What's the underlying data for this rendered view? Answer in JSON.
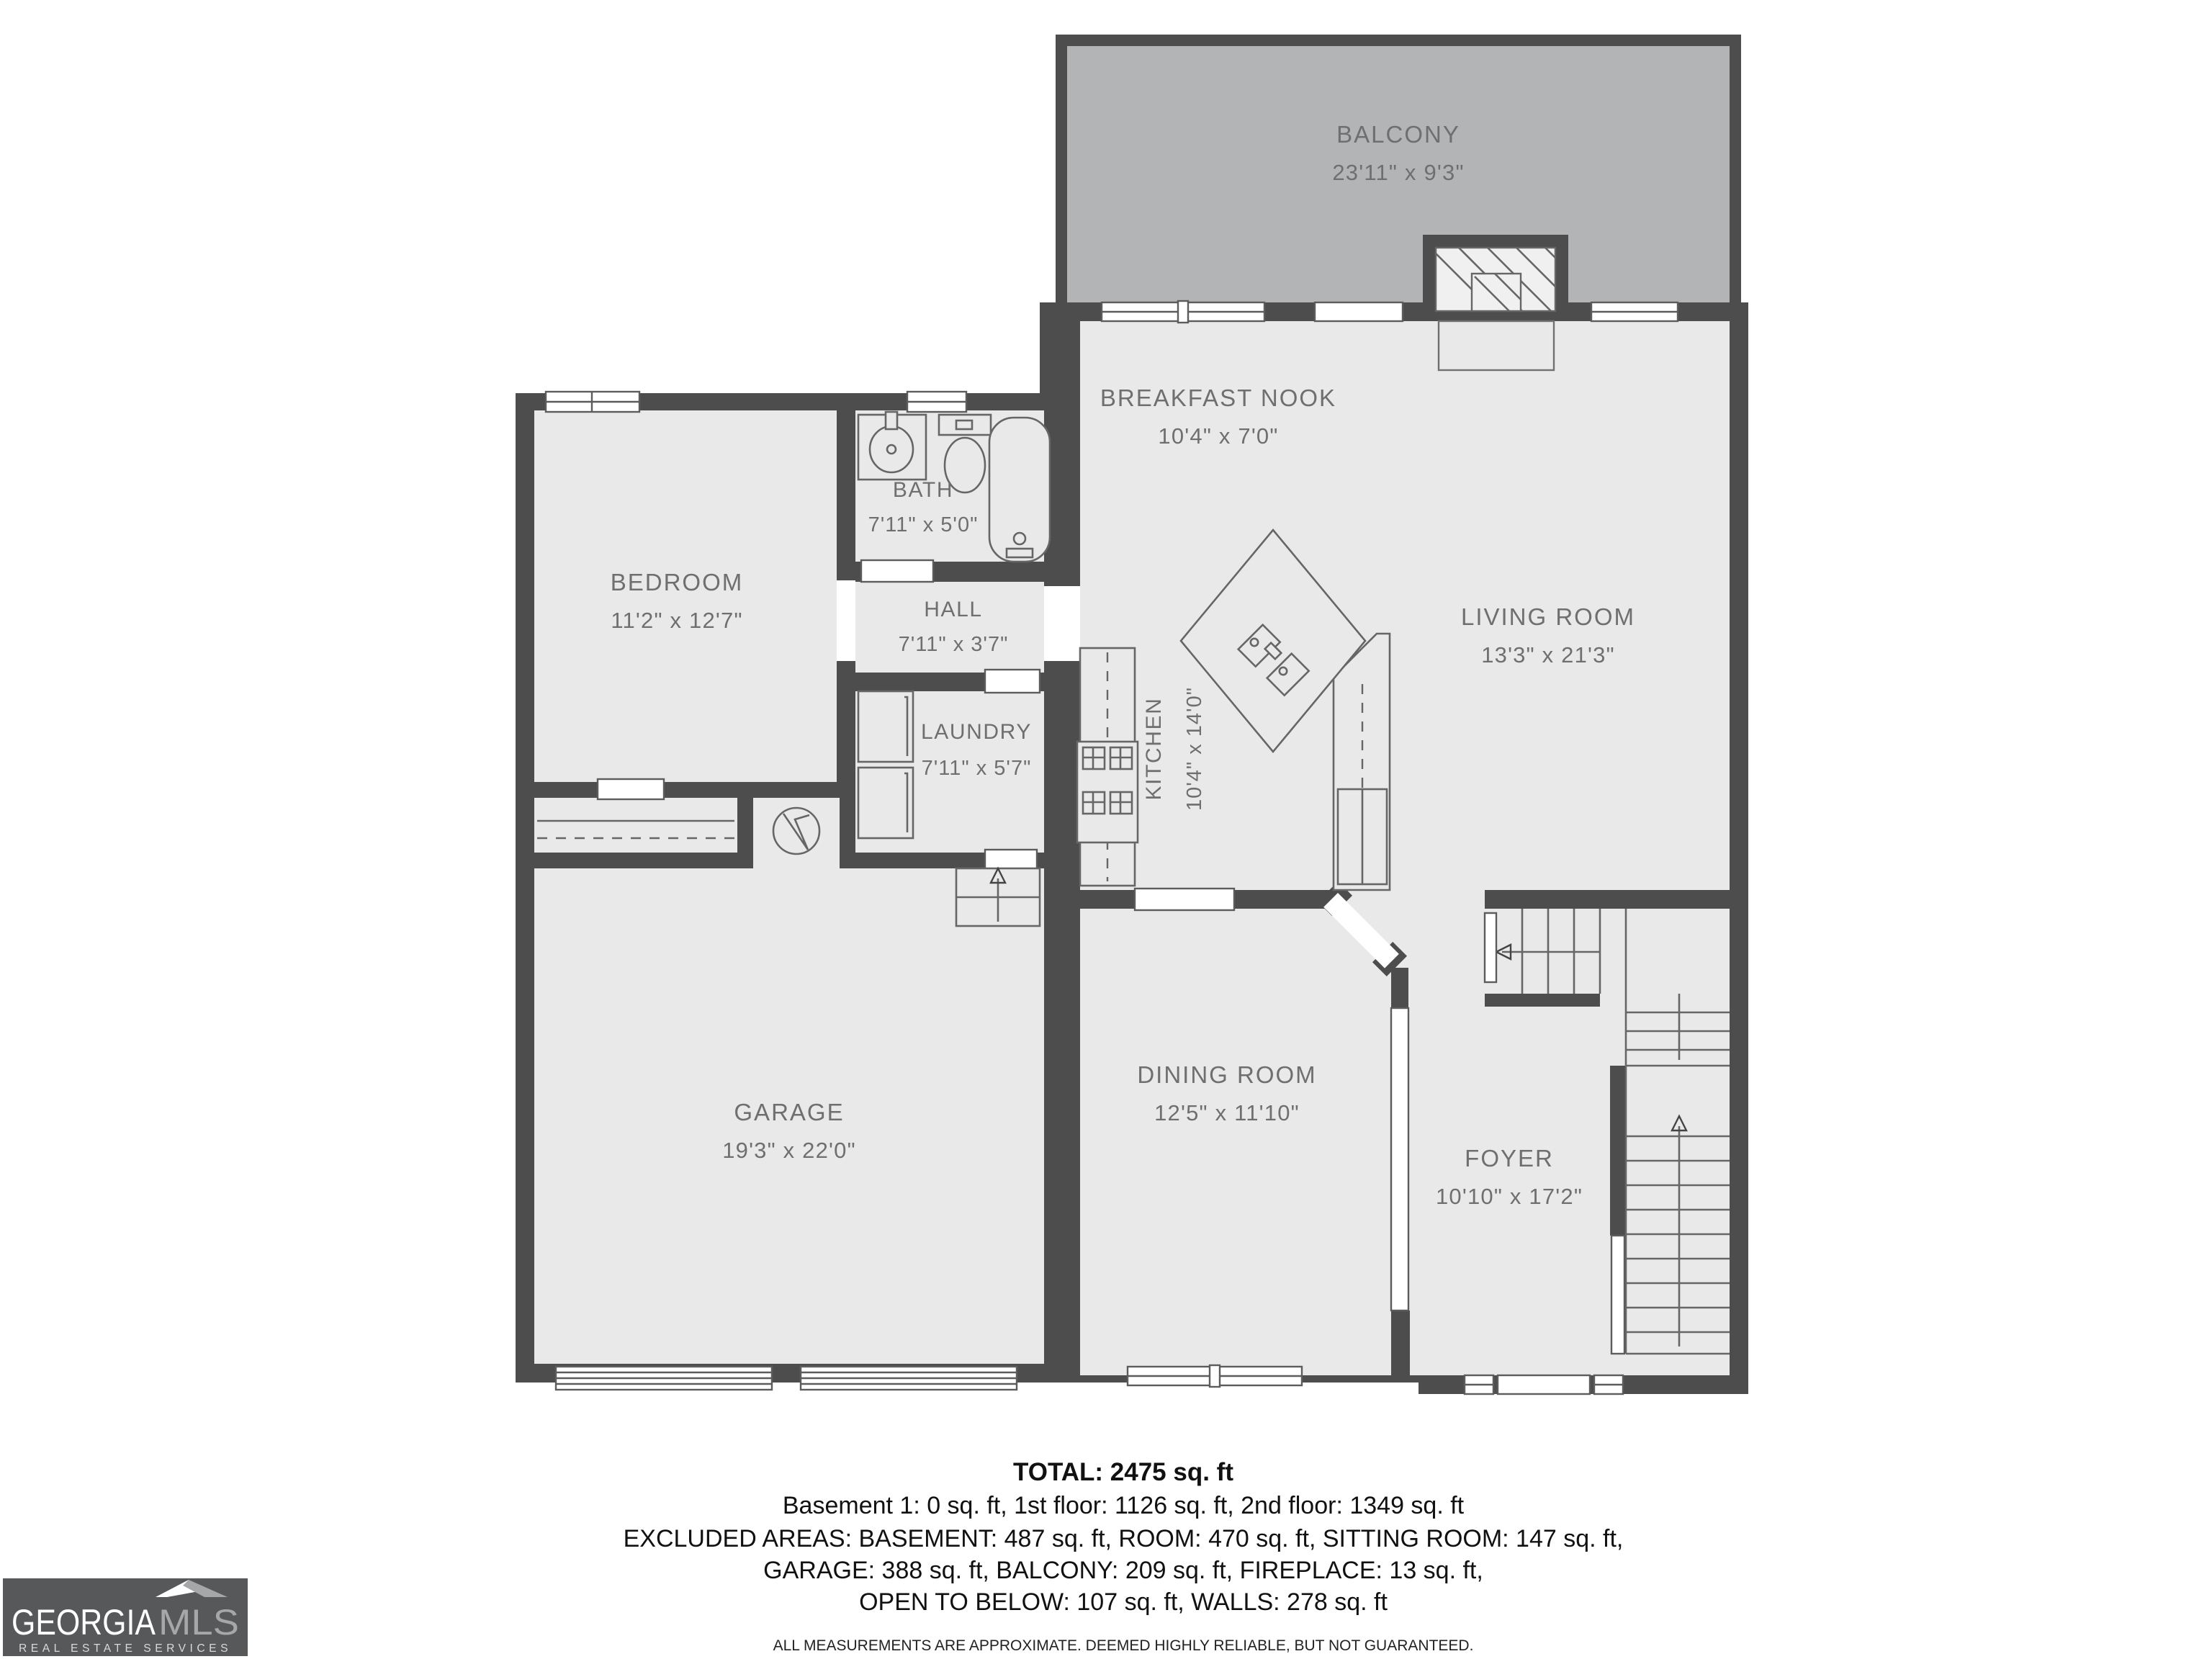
{
  "plan": {
    "rooms": [
      {
        "name": "BALCONY",
        "dims": "23'11\" x 9'3\""
      },
      {
        "name": "BREAKFAST NOOK",
        "dims": "10'4\" x 7'0\""
      },
      {
        "name": "LIVING ROOM",
        "dims": "13'3\" x 21'3\""
      },
      {
        "name": "BEDROOM",
        "dims": "11'2\" x 12'7\""
      },
      {
        "name": "BATH",
        "dims": "7'11\" x 5'0\""
      },
      {
        "name": "HALL",
        "dims": "7'11\" x 3'7\""
      },
      {
        "name": "LAUNDRY",
        "dims": "7'11\" x 5'7\""
      },
      {
        "name": "KITCHEN",
        "dims": "10'4\" x 14'0\""
      },
      {
        "name": "GARAGE",
        "dims": "19'3\" x 22'0\""
      },
      {
        "name": "DINING ROOM",
        "dims": "12'5\" x 11'10\""
      },
      {
        "name": "FOYER",
        "dims": "10'10\" x 17'2\""
      }
    ],
    "footer": {
      "total": "TOTAL: 2475 sq. ft",
      "line1": "Basement 1: 0 sq. ft, 1st floor: 1126 sq. ft, 2nd floor: 1349 sq. ft",
      "line2": "EXCLUDED AREAS: BASEMENT: 487 sq. ft, ROOM: 470 sq. ft, SITTING ROOM: 147 sq. ft,",
      "line3": "GARAGE: 388 sq. ft, BALCONY: 209 sq. ft, FIREPLACE: 13 sq. ft,",
      "line4": "OPEN TO BELOW: 107 sq. ft, WALLS: 278 sq. ft",
      "disclaimer": "ALL MEASUREMENTS ARE APPROXIMATE. DEEMED HIGHLY RELIABLE, BUT NOT GUARANTEED."
    },
    "logo": {
      "brand_primary": "GEORGIA",
      "brand_secondary": "MLS",
      "tagline": "REAL ESTATE SERVICES"
    },
    "fixtures": [
      "bathtub",
      "toilet",
      "sink",
      "washer",
      "dryer",
      "water-heater",
      "stove",
      "refrigerator",
      "kitchen-island",
      "fireplace",
      "stairs",
      "garage-door",
      "window",
      "door-opening"
    ],
    "colors": {
      "wall": "#4d4d4d",
      "floor": "#e9e9e9",
      "balcony": "#b3b4b6",
      "label": "#6f6f6f",
      "opening": "#ffffff",
      "logo_bg": "#57585a"
    }
  }
}
